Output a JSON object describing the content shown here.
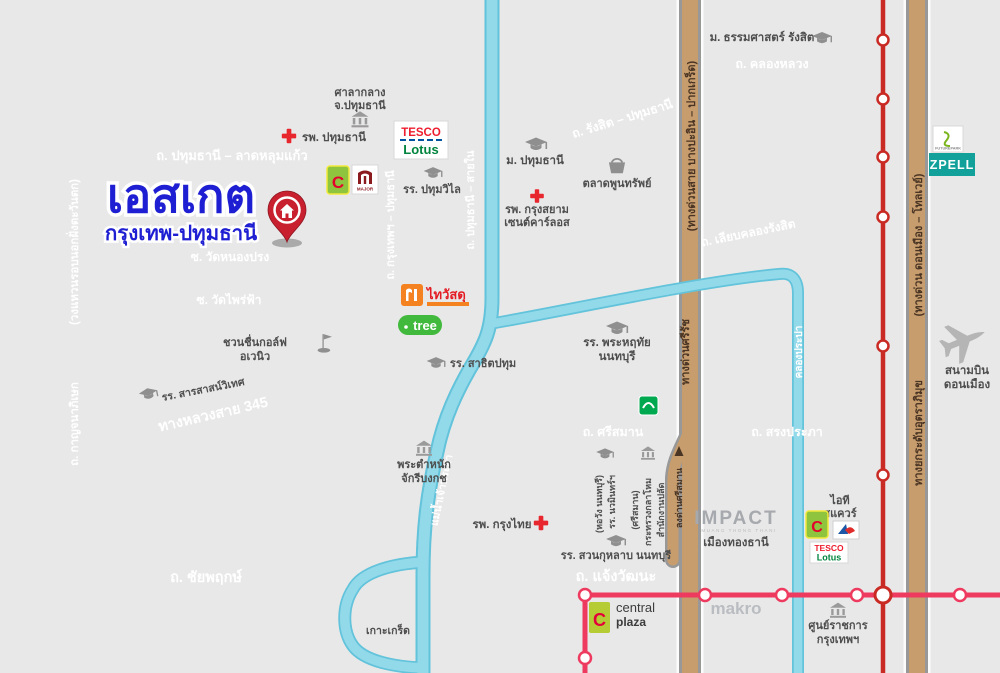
{
  "map_title": {
    "name": "เอสเกต",
    "area": "กรุงเทพ-ปทุมธานี"
  },
  "roads": {
    "ring_outer": "(วงแหวนรอบนอกฝั่งตะวันตก)",
    "kanchanaphisek": "ถ. กาญจนาภิเษก",
    "pathum_latlumkaeo": "ถ. ปทุมธานี – ลาดหลุมแก้ว",
    "wat_nongprong": "ซ. วัดหนองปรง",
    "wat_phraifa": "ซ. วัดไพร่ฟ้า",
    "bangkok_pathum": "ถ. กรุงเทพฯ – ปทุมธานี",
    "pathum_sainai": "ถ. ปทุมธานี – สายใน",
    "rangsit_pathum": "ถ. รังสิต – ปทุมธานี",
    "khlong_luang": "ถ. คลองหลวง",
    "liap_khlong_rangsit": "ถ. เลียบคลองรังสิต",
    "highway_345": "ทางหลวงสาย 345",
    "srisaman": "ถ. ศรีสมาน",
    "songprapha": "ถ. สรงประภา",
    "chaiyaphruek": "ถ. ชัยพฤกษ์",
    "chaengwattana": "ถ. แจ้งวัฒนะ"
  },
  "expressways": {
    "bang_pa_in": "(ทางด่วนสาย บางปะอิน – ปากเกร็ด)",
    "sirat": "ทางด่วนศรีรัช",
    "exit_srisaman": "ลงด่านศรีสมาน",
    "don_mueang_tollway": "(ทางด่วน ดอนเมือง – โทลเวย์)",
    "uttaraphimuk": "ทางยกระดับอุตราภิมุข"
  },
  "waterways": {
    "chao_phraya": "แม่น้ำเจ้าพระยา",
    "khlong_prapa": "คลองประปา",
    "koh_kret": "เกาะเกร็ด"
  },
  "places": {
    "city_hall": [
      "ศาลากลาง",
      "จ.ปทุมธานี"
    ],
    "pathum_hospital": "รพ. ปทุมธานี",
    "pathumwilai_school": "รร. ปทุมวิไล",
    "pathum_university": "ม. ปทุมธานี",
    "poonsap_market": "ตลาดพูนทรัพย์",
    "krungsiam_hospital": [
      "รพ. กรุงสยาม",
      "เซนต์คาร์ลอส"
    ],
    "thammasat_university": "ม. ธรรมศาสตร์ รังสิต",
    "phraharuthai_school": [
      "รร. พระหฤทัย",
      "นนทบุรี"
    ],
    "satit_pathum_school": "รร. สาธิตปทุม",
    "sarasas_school": "รร. สารสาสน์วิเทศ",
    "chuanchuen_golf": [
      "ชวนชื่นกอล์ฟ",
      "อเวนิว"
    ],
    "phra_tamnak": [
      "พระตำหนัก",
      "จักรีบงกช"
    ],
    "krungthai_hospital": "รพ. กรุงไทย",
    "nawamin_school": [
      "รร. นวมินทร์ฯ",
      "(หอวัง นนทบุรี)"
    ],
    "defense_office": [
      "สำนักงานปลัด",
      "กระทรวงกลาโหม",
      "(ศรีสมาน)"
    ],
    "suankularb_school": "รร. สวนกุหลาบ นนทบุรี",
    "don_mueang_airport": [
      "สนามบิน",
      "ดอนเมือง"
    ],
    "impact": {
      "logo": "IMPACT",
      "sub": "MUANG THONG THANI",
      "name": "เมืองทองธานี"
    },
    "it_square": [
      "ไอที",
      "สแควร์"
    ],
    "government_complex": [
      "ศูนย์ราชการ",
      "กรุงเทพฯ"
    ],
    "makro": "makro"
  },
  "logos": {
    "tesco": "TESCO",
    "lotus": "Lotus",
    "big_c": "C",
    "major": "MAJOR",
    "thai_watsadu": "ไทวัสดุ",
    "tree": "tree",
    "future_park": "FUTUREPARK",
    "zpell": "ZPELL",
    "central": "central",
    "plaza": "plaza"
  },
  "colors": {
    "block_bg": "#e9e8e8",
    "road": "#7e7e7e",
    "road_casing": "#ffffff",
    "expressway": "#c79d6e",
    "water": "#92d9ea",
    "srt_red_line": "#c92b24",
    "mrt_pink_line": "#ee3a5e",
    "title_blue": "#1e1ed2",
    "pin_red": "#c8202f",
    "hospital_red": "#e8262d"
  }
}
